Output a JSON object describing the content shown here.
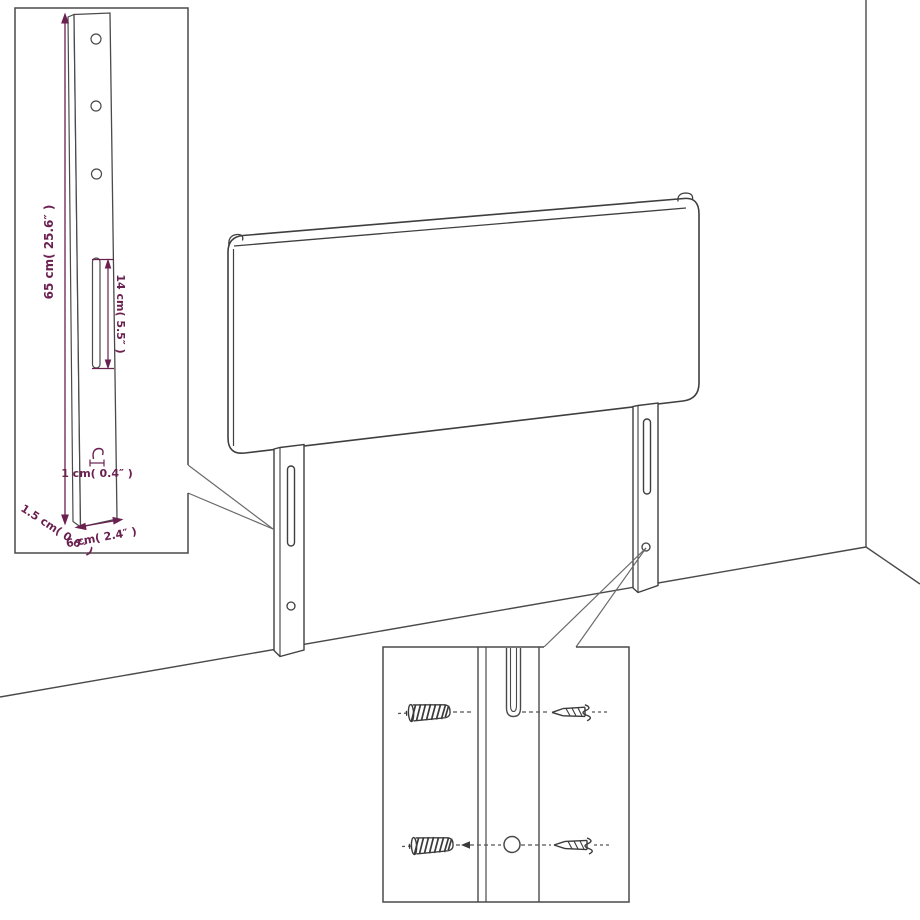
{
  "page": {
    "title": "Headboard wall-mounting dimension diagram",
    "background": "#ffffff"
  },
  "colors": {
    "line": "#4a4a4a",
    "line_soft": "#5a5a5a",
    "dimension": "#6a2150",
    "fill": "#ffffff"
  },
  "bracket_inset": {
    "name": "bracket-detail-inset",
    "dim_height": "65 cm( 25.6″ )",
    "dim_slot": "14 cm( 5.5″ )",
    "dim_hook": "1 cm( 0.4″ )",
    "dim_depth": "1.5 cm( 0.6″ )",
    "dim_width": "6 cm( 2.4″ )",
    "hole_count": 3,
    "slot_count": 1
  },
  "headboard": {
    "name": "upholstered-headboard-panel",
    "legs": 2,
    "slots_per_leg": 1,
    "holes_per_leg": 1
  },
  "mounting_inset": {
    "name": "fastener-detail-inset",
    "rows": [
      {
        "left": "wall-plug-icon",
        "target": "slot",
        "right": "screw-icon"
      },
      {
        "left": "wall-plug-icon",
        "target": "round-hole",
        "right": "screw-icon"
      }
    ]
  }
}
